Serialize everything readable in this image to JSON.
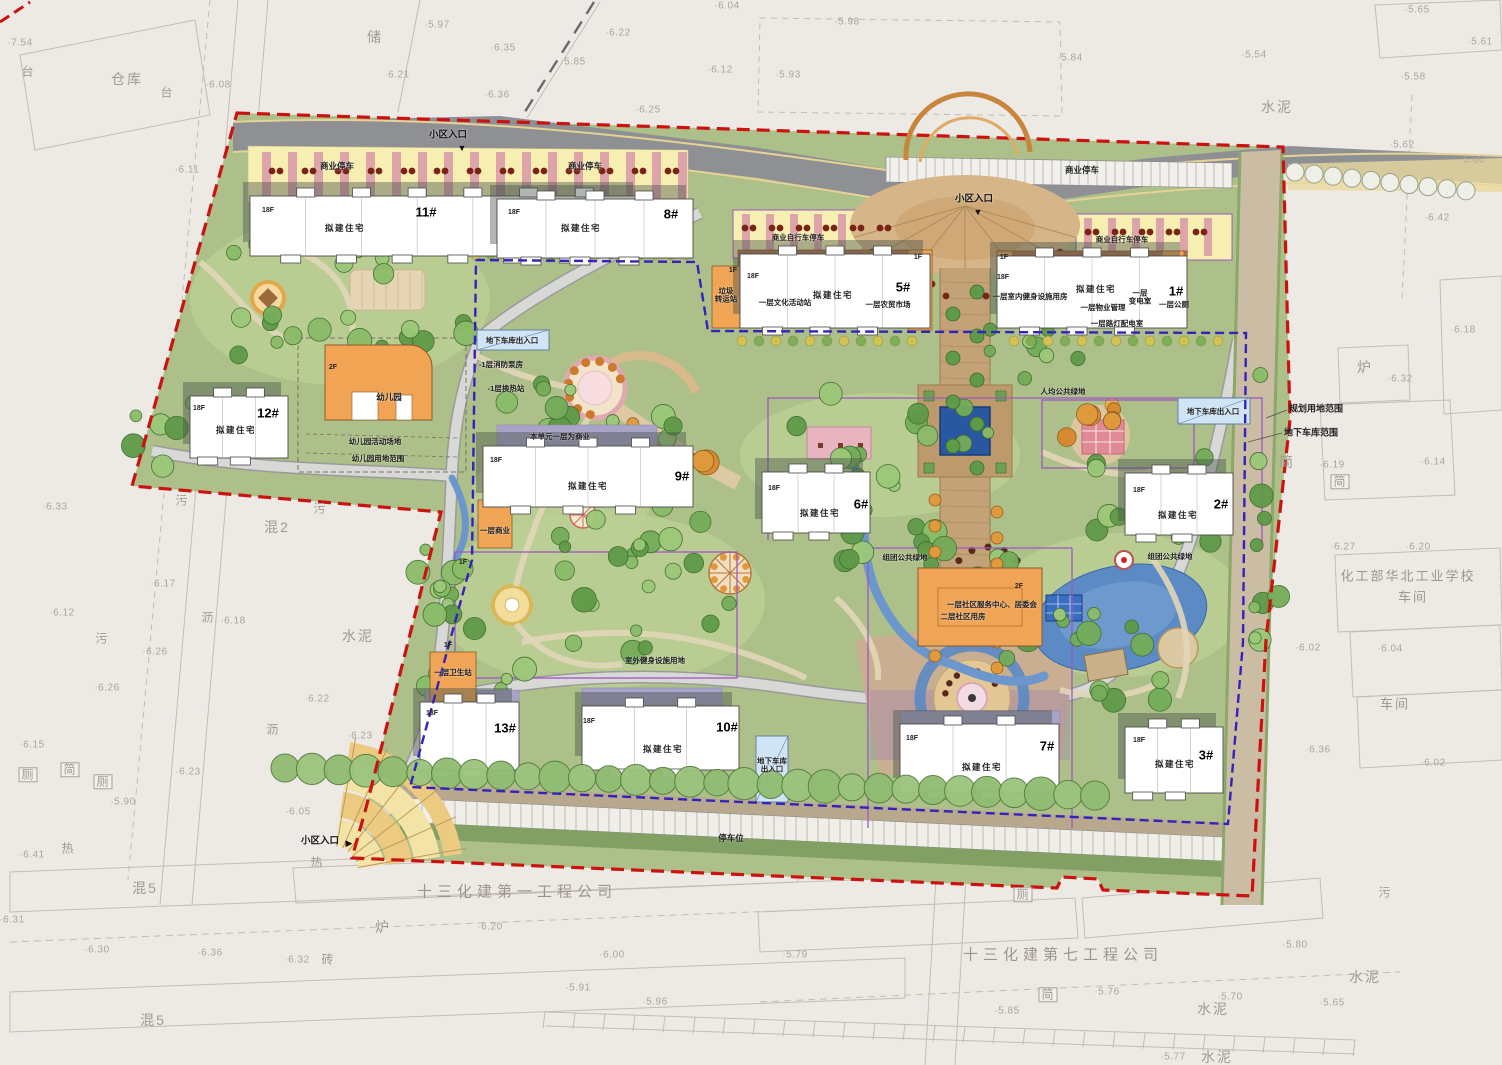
{
  "canvas": {
    "w": 1502,
    "h": 1065
  },
  "colors": {
    "site_green": "#adc089",
    "road_gray": "#8e9094",
    "commercial_yellow": "#f7efb2",
    "stripe_pink": "#d898a8",
    "building_white": "#ffffff",
    "ancillary_orange": "#f0a455",
    "podium_brown": "#b5744a",
    "podium_purple": "#a9a3c7",
    "water_blue": "#5b8ac4",
    "boundary_red": "#cc1111",
    "garage_blue": "#3322bb",
    "garage_box_blue": "#cfe4f5"
  },
  "boundary_labels": {
    "planning": "规划用地范围",
    "garage": "地下车库范围"
  },
  "entrances": [
    {
      "label": "小区入口",
      "x": 448,
      "y": 136,
      "arrow": "▼",
      "ax": 462,
      "ay": 148
    },
    {
      "label": "小区入口",
      "x": 974,
      "y": 200,
      "arrow": "▼",
      "ax": 978,
      "ay": 212
    },
    {
      "label": "小区入口",
      "x": 320,
      "y": 842,
      "arrow": "▶",
      "ax": 349,
      "ay": 843
    }
  ],
  "buildings": [
    {
      "id": "11#",
      "floors": "18F",
      "use": "拟建住宅",
      "bx": 250,
      "by": 196,
      "bw": 390,
      "bh": 60,
      "fx": 268,
      "fy": 211,
      "ux": 345,
      "uy": 229,
      "nx": 426,
      "ny": 213
    },
    {
      "id": "8#",
      "floors": "18F",
      "use": "拟建住宅",
      "bx": 497,
      "by": 199,
      "bw": 196,
      "bh": 59,
      "fx": 514,
      "fy": 213,
      "ux": 581,
      "uy": 229,
      "nx": 671,
      "ny": 215
    },
    {
      "id": "5#",
      "floors": "18F",
      "use": "拟建住宅",
      "bx": 740,
      "by": 254,
      "bw": 190,
      "bh": 74,
      "fx": 753,
      "fy": 277,
      "ux": 833,
      "uy": 296,
      "nx": 903,
      "ny": 288
    },
    {
      "id": "1#",
      "floors": "18F",
      "use": "拟建住宅",
      "bx": 997,
      "by": 256,
      "bw": 190,
      "bh": 72,
      "fx": 1003,
      "fy": 278,
      "ux": 1096,
      "uy": 290,
      "nx": 1176,
      "ny": 292
    },
    {
      "id": "12#",
      "floors": "18F",
      "use": "拟建住宅",
      "bx": 190,
      "by": 396,
      "bw": 98,
      "bh": 62,
      "fx": 199,
      "fy": 409,
      "ux": 236,
      "uy": 431,
      "nx": 268,
      "ny": 414
    },
    {
      "id": "9#",
      "floors": "18F",
      "use": "拟建住宅",
      "bx": 483,
      "by": 446,
      "bw": 210,
      "bh": 61,
      "fx": 496,
      "fy": 461,
      "ux": 588,
      "uy": 487,
      "nx": 682,
      "ny": 477
    },
    {
      "id": "6#",
      "floors": "18F",
      "use": "拟建住宅",
      "bx": 762,
      "by": 472,
      "bw": 108,
      "bh": 61,
      "fx": 774,
      "fy": 489,
      "ux": 820,
      "uy": 514,
      "nx": 861,
      "ny": 505
    },
    {
      "id": "2#",
      "floors": "18F",
      "use": "拟建住宅",
      "bx": 1125,
      "by": 473,
      "bw": 108,
      "bh": 62,
      "fx": 1139,
      "fy": 491,
      "ux": 1178,
      "uy": 516,
      "nx": 1221,
      "ny": 505
    },
    {
      "id": "13#",
      "floors": "18F",
      "use": "",
      "bx": 420,
      "by": 702,
      "bw": 99,
      "bh": 68,
      "fx": 432,
      "fy": 714,
      "ux": 0,
      "uy": 0,
      "nx": 505,
      "ny": 729
    },
    {
      "id": "10#",
      "floors": "18F",
      "use": "拟建住宅",
      "bx": 582,
      "by": 706,
      "bw": 157,
      "bh": 64,
      "fx": 589,
      "fy": 722,
      "ux": 663,
      "uy": 750,
      "nx": 727,
      "ny": 728
    },
    {
      "id": "7#",
      "floors": "18F",
      "use": "拟建住宅",
      "bx": 900,
      "by": 724,
      "bw": 159,
      "bh": 68,
      "fx": 912,
      "fy": 739,
      "ux": 982,
      "uy": 768,
      "nx": 1047,
      "ny": 747
    },
    {
      "id": "3#",
      "floors": "18F",
      "use": "拟建住宅",
      "bx": 1125,
      "by": 727,
      "bw": 98,
      "bh": 66,
      "fx": 1139,
      "fy": 741,
      "ux": 1175,
      "uy": 765,
      "nx": 1206,
      "ny": 756
    }
  ],
  "annotations": [
    {
      "t": "商业停车",
      "x": 337,
      "y": 167,
      "c": "p"
    },
    {
      "t": "商业停车",
      "x": 585,
      "y": 167,
      "c": "p"
    },
    {
      "t": "商业停车",
      "x": 1082,
      "y": 171,
      "c": "p"
    },
    {
      "t": "商业自行车停车",
      "x": 798,
      "y": 238,
      "c": "p7"
    },
    {
      "t": "商业自行车停车",
      "x": 1122,
      "y": 240,
      "c": "p7"
    },
    {
      "t": "垃圾\n转运站",
      "x": 726,
      "y": 296,
      "c": "p7"
    },
    {
      "t": "一层文化活动站",
      "x": 785,
      "y": 303,
      "c": "p7"
    },
    {
      "t": "一层农贸市场",
      "x": 888,
      "y": 305,
      "c": "p7"
    },
    {
      "t": "一层室内健身设施用房",
      "x": 1030,
      "y": 297,
      "c": "p7"
    },
    {
      "t": "一层物业管理",
      "x": 1103,
      "y": 308,
      "c": "p7"
    },
    {
      "t": "一层\n变电室",
      "x": 1140,
      "y": 298,
      "c": "p7"
    },
    {
      "t": "一层公厕",
      "x": 1174,
      "y": 305,
      "c": "p7"
    },
    {
      "t": "一层路灯配电室",
      "x": 1117,
      "y": 324,
      "c": "p7"
    },
    {
      "t": "1F",
      "x": 918,
      "y": 258,
      "c": "fl"
    },
    {
      "t": "1F",
      "x": 1004,
      "y": 258,
      "c": "fl"
    },
    {
      "t": "1F",
      "x": 733,
      "y": 271,
      "c": "fl"
    },
    {
      "t": "1F",
      "x": 463,
      "y": 563,
      "c": "fl"
    },
    {
      "t": "1F",
      "x": 448,
      "y": 646,
      "c": "fl"
    },
    {
      "t": "2F",
      "x": 333,
      "y": 368,
      "c": "fl"
    },
    {
      "t": "2F",
      "x": 1019,
      "y": 587,
      "c": "fl"
    },
    {
      "t": "幼儿园",
      "x": 389,
      "y": 398,
      "c": "p"
    },
    {
      "t": "幼儿园活动场地",
      "x": 375,
      "y": 442,
      "c": "p7"
    },
    {
      "t": "幼儿园用地范围",
      "x": 378,
      "y": 459,
      "c": "p7"
    },
    {
      "t": "地下车库出入口",
      "x": 512,
      "y": 341,
      "c": "p7"
    },
    {
      "t": "地下车库出入口",
      "x": 1213,
      "y": 412,
      "c": "p7"
    },
    {
      "t": "地下车库\n出入口",
      "x": 772,
      "y": 766,
      "c": "p7"
    },
    {
      "t": "-1层消防泵房",
      "x": 501,
      "y": 365,
      "c": "p7"
    },
    {
      "t": "-1层换热站",
      "x": 506,
      "y": 389,
      "c": "p7"
    },
    {
      "t": "本单元一层为商业",
      "x": 560,
      "y": 437,
      "c": "p7"
    },
    {
      "t": "人均公共绿地",
      "x": 1063,
      "y": 392,
      "c": "p7"
    },
    {
      "t": "组团公共绿地",
      "x": 905,
      "y": 558,
      "c": "p7"
    },
    {
      "t": "组团公共绿地",
      "x": 1170,
      "y": 557,
      "c": "p7"
    },
    {
      "t": "室外健身设施用地",
      "x": 655,
      "y": 661,
      "c": "p7"
    },
    {
      "t": "一层商业",
      "x": 495,
      "y": 531,
      "c": "p7"
    },
    {
      "t": "一层卫生站",
      "x": 453,
      "y": 673,
      "c": "p7"
    },
    {
      "t": "一层社区服务中心、居委会",
      "x": 992,
      "y": 605,
      "c": "p7"
    },
    {
      "t": "二层社区用房",
      "x": 963,
      "y": 617,
      "c": "p7"
    },
    {
      "t": "停车位",
      "x": 731,
      "y": 839,
      "c": "p"
    }
  ],
  "cadastral_labels": [
    {
      "t": "台",
      "x": 28,
      "y": 72,
      "c": "gray"
    },
    {
      "t": "仓库",
      "x": 127,
      "y": 80,
      "c": "grayb"
    },
    {
      "t": "台",
      "x": 167,
      "y": 93,
      "c": "gray"
    },
    {
      "t": "储",
      "x": 375,
      "y": 38,
      "c": "grayb"
    },
    {
      "t": "水泥",
      "x": 1277,
      "y": 108,
      "c": "grayb"
    },
    {
      "t": "污",
      "x": 182,
      "y": 501,
      "c": "gray"
    },
    {
      "t": "污",
      "x": 320,
      "y": 509,
      "c": "gray"
    },
    {
      "t": "混2",
      "x": 277,
      "y": 528,
      "c": "grayb"
    },
    {
      "t": "沥",
      "x": 208,
      "y": 618,
      "c": "gray"
    },
    {
      "t": "水泥",
      "x": 358,
      "y": 637,
      "c": "grayb"
    },
    {
      "t": "沥",
      "x": 273,
      "y": 730,
      "c": "gray"
    },
    {
      "t": "污",
      "x": 102,
      "y": 639,
      "c": "gray"
    },
    {
      "t": "厕",
      "x": 28,
      "y": 775,
      "c": "gray box"
    },
    {
      "t": "简",
      "x": 70,
      "y": 770,
      "c": "gray box"
    },
    {
      "t": "厕",
      "x": 103,
      "y": 782,
      "c": "gray box"
    },
    {
      "t": "热",
      "x": 68,
      "y": 849,
      "c": "gray"
    },
    {
      "t": "混5",
      "x": 145,
      "y": 889,
      "c": "grayb"
    },
    {
      "t": "热",
      "x": 317,
      "y": 863,
      "c": "gray"
    },
    {
      "t": "砖",
      "x": 328,
      "y": 960,
      "c": "gray"
    },
    {
      "t": "炉",
      "x": 383,
      "y": 928,
      "c": "grayb"
    },
    {
      "t": "混5",
      "x": 153,
      "y": 1021,
      "c": "grayb"
    },
    {
      "t": "炉",
      "x": 1365,
      "y": 368,
      "c": "grayb"
    },
    {
      "t": "简",
      "x": 1287,
      "y": 463,
      "c": "grayb"
    },
    {
      "t": "简",
      "x": 1340,
      "y": 482,
      "c": "gray box"
    },
    {
      "t": "厕",
      "x": 1023,
      "y": 895,
      "c": "gray box"
    },
    {
      "t": "污",
      "x": 1385,
      "y": 893,
      "c": "gray"
    },
    {
      "t": "水泥",
      "x": 1365,
      "y": 978,
      "c": "grayb"
    },
    {
      "t": "简",
      "x": 1048,
      "y": 995,
      "c": "gray box"
    },
    {
      "t": "水泥",
      "x": 1213,
      "y": 1010,
      "c": "grayb"
    },
    {
      "t": "水泥",
      "x": 1217,
      "y": 1058,
      "c": "grayb"
    },
    {
      "t": "十三化建第一工程公司",
      "x": 517,
      "y": 893,
      "c": "lg"
    },
    {
      "t": "十三化建第七工程公司",
      "x": 1063,
      "y": 956,
      "c": "lg"
    },
    {
      "t": "化工部华北工业学校",
      "x": 1408,
      "y": 577,
      "c": "sch"
    },
    {
      "t": "车间",
      "x": 1413,
      "y": 598,
      "c": "sch"
    },
    {
      "t": "车间",
      "x": 1395,
      "y": 705,
      "c": "sch"
    }
  ],
  "elevations": [
    {
      "v": "7.54",
      "x": 20,
      "y": 43
    },
    {
      "v": "6.08",
      "x": 218,
      "y": 85
    },
    {
      "v": "6.11",
      "x": 187,
      "y": 170
    },
    {
      "v": "6.21",
      "x": 397,
      "y": 75
    },
    {
      "v": "5.97",
      "x": 437,
      "y": 25
    },
    {
      "v": "6.35",
      "x": 503,
      "y": 48
    },
    {
      "v": "6.36",
      "x": 497,
      "y": 95
    },
    {
      "v": "5.85",
      "x": 573,
      "y": 62
    },
    {
      "v": "6.22",
      "x": 618,
      "y": 33
    },
    {
      "v": "6.25",
      "x": 648,
      "y": 110
    },
    {
      "v": "6.12",
      "x": 720,
      "y": 70
    },
    {
      "v": "5.93",
      "x": 788,
      "y": 75
    },
    {
      "v": "5.98",
      "x": 847,
      "y": 22
    },
    {
      "v": "6.04",
      "x": 727,
      "y": 6
    },
    {
      "v": "5.84",
      "x": 1070,
      "y": 58
    },
    {
      "v": "5.54",
      "x": 1254,
      "y": 55
    },
    {
      "v": "5.65",
      "x": 1417,
      "y": 10
    },
    {
      "v": "5.61",
      "x": 1480,
      "y": 42
    },
    {
      "v": "5.58",
      "x": 1413,
      "y": 77
    },
    {
      "v": "5.62",
      "x": 1402,
      "y": 145
    },
    {
      "v": "5.66",
      "x": 1472,
      "y": 160
    },
    {
      "v": "6.42",
      "x": 1437,
      "y": 218
    },
    {
      "v": "6.18",
      "x": 1463,
      "y": 330
    },
    {
      "v": "6.32",
      "x": 1400,
      "y": 379
    },
    {
      "v": "6.19",
      "x": 1332,
      "y": 465
    },
    {
      "v": "6.14",
      "x": 1433,
      "y": 462
    },
    {
      "v": "6.27",
      "x": 1343,
      "y": 547
    },
    {
      "v": "6.20",
      "x": 1418,
      "y": 547
    },
    {
      "v": "6.02",
      "x": 1308,
      "y": 648
    },
    {
      "v": "6.04",
      "x": 1390,
      "y": 649
    },
    {
      "v": "6.36",
      "x": 1318,
      "y": 750
    },
    {
      "v": "6.02",
      "x": 1433,
      "y": 763
    },
    {
      "v": "6.33",
      "x": 55,
      "y": 507
    },
    {
      "v": "6.12",
      "x": 62,
      "y": 613
    },
    {
      "v": "6.17",
      "x": 163,
      "y": 584
    },
    {
      "v": "6.18",
      "x": 233,
      "y": 621
    },
    {
      "v": "6.26",
      "x": 155,
      "y": 652
    },
    {
      "v": "6.26",
      "x": 107,
      "y": 688
    },
    {
      "v": "6.22",
      "x": 317,
      "y": 699
    },
    {
      "v": "6.23",
      "x": 360,
      "y": 736
    },
    {
      "v": "6.15",
      "x": 32,
      "y": 745
    },
    {
      "v": "6.23",
      "x": 188,
      "y": 772
    },
    {
      "v": "5.90",
      "x": 123,
      "y": 802
    },
    {
      "v": "6.05",
      "x": 298,
      "y": 812
    },
    {
      "v": "6.41",
      "x": 32,
      "y": 855
    },
    {
      "v": "6.31",
      "x": 12,
      "y": 920
    },
    {
      "v": "6.30",
      "x": 97,
      "y": 950
    },
    {
      "v": "6.36",
      "x": 210,
      "y": 953
    },
    {
      "v": "6.32",
      "x": 297,
      "y": 960
    },
    {
      "v": "6.20",
      "x": 490,
      "y": 927
    },
    {
      "v": "6.00",
      "x": 612,
      "y": 955
    },
    {
      "v": "5.91",
      "x": 578,
      "y": 988
    },
    {
      "v": "5.96",
      "x": 655,
      "y": 1002
    },
    {
      "v": "5.79",
      "x": 795,
      "y": 955
    },
    {
      "v": "5.80",
      "x": 1295,
      "y": 945
    },
    {
      "v": "5.76",
      "x": 1107,
      "y": 992
    },
    {
      "v": "5.70",
      "x": 1230,
      "y": 997
    },
    {
      "v": "5.65",
      "x": 1332,
      "y": 1003
    },
    {
      "v": "5.85",
      "x": 1007,
      "y": 1011
    },
    {
      "v": "5.77",
      "x": 1173,
      "y": 1057
    }
  ]
}
